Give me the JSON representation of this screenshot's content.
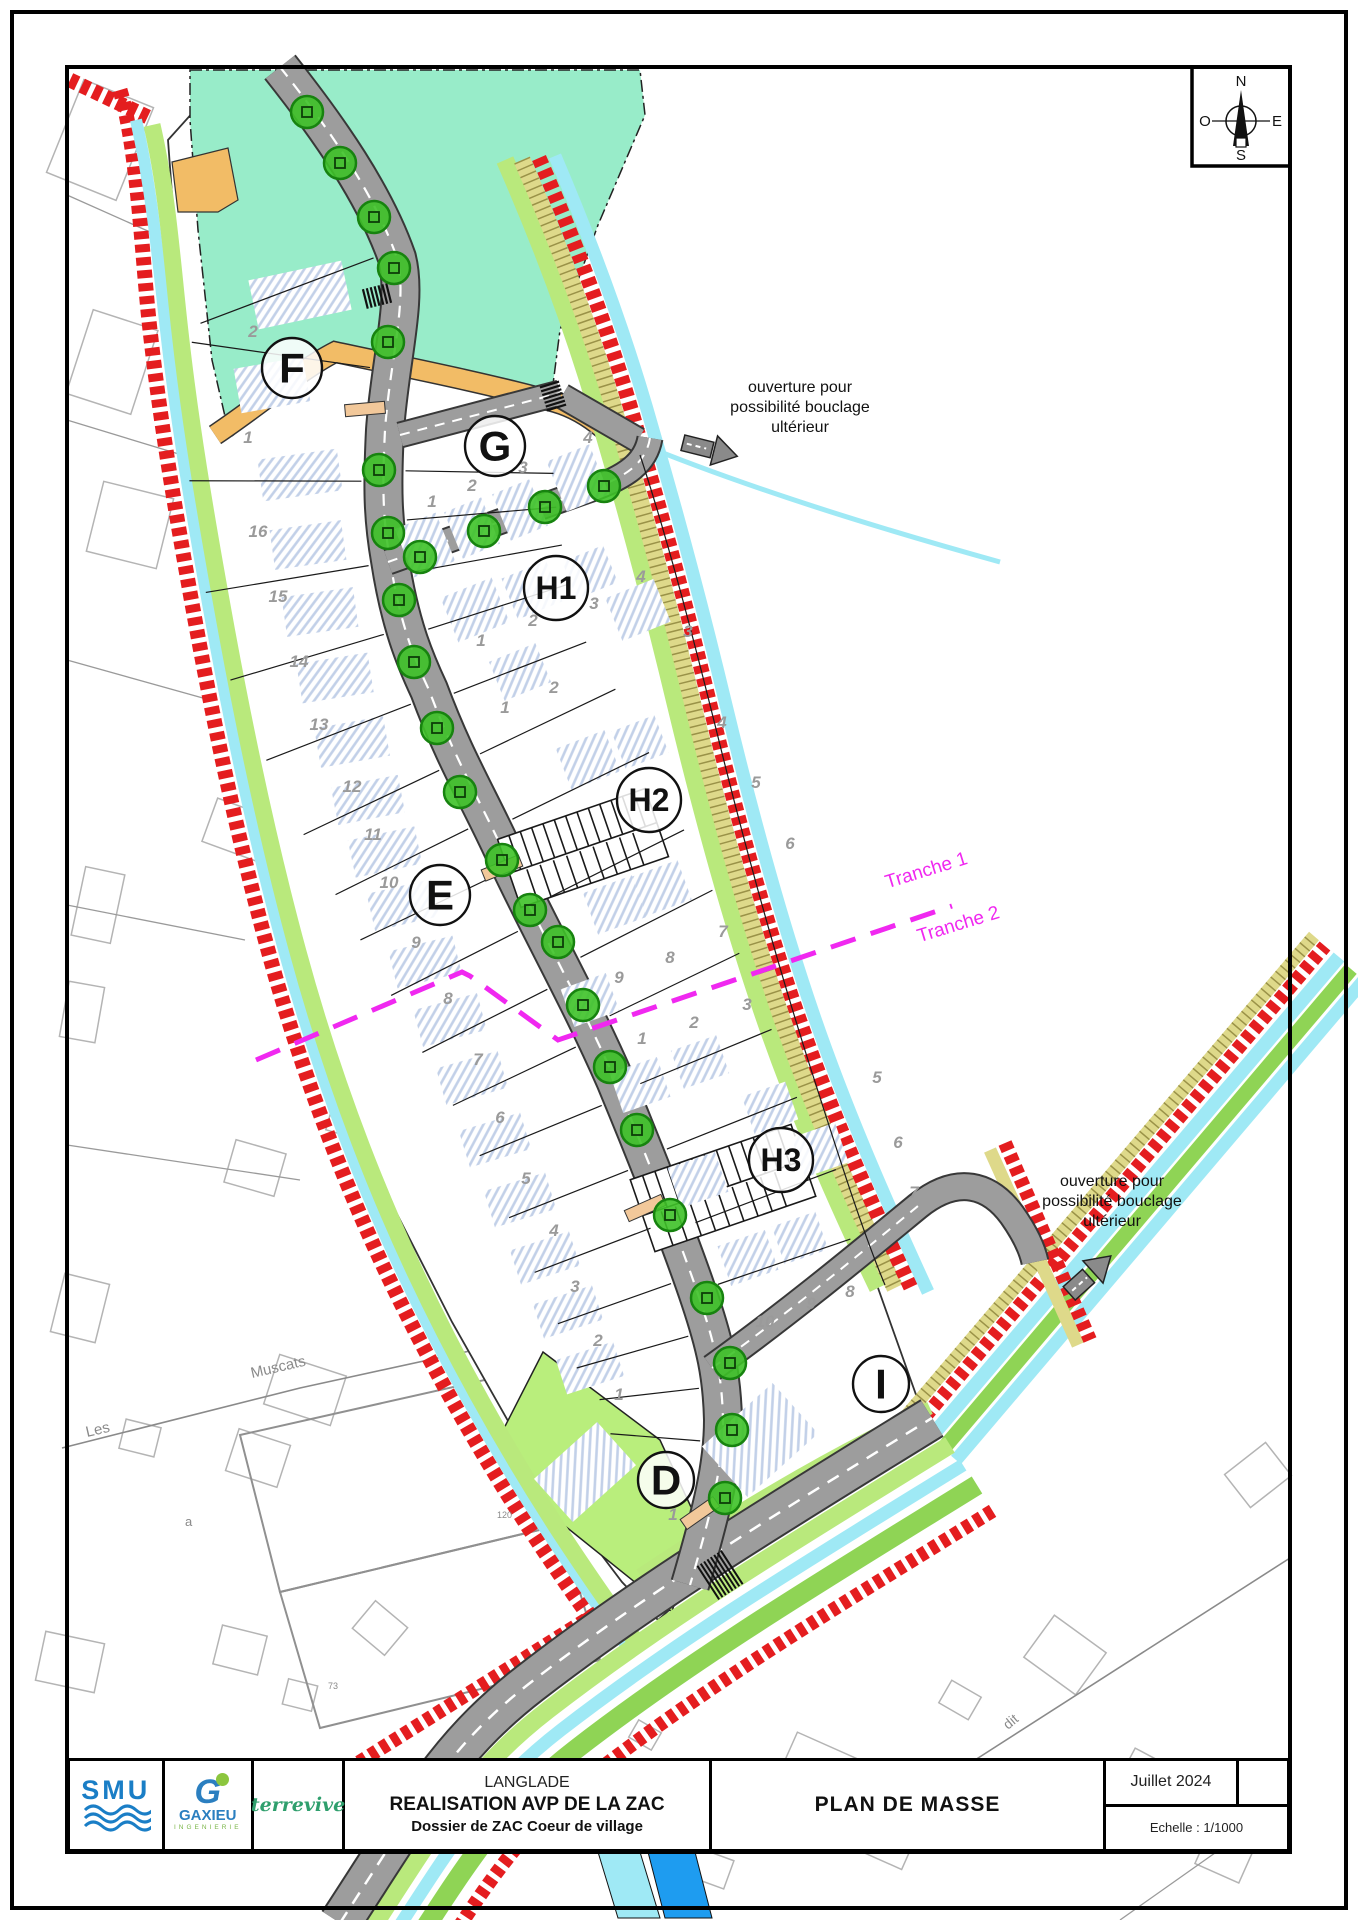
{
  "title_block": {
    "smu": "SMU",
    "gaxieu": "GAXIEU",
    "gaxieu_g": "G",
    "gaxieu_sub": "INGENIERIE",
    "terravia": "terrevive",
    "commune": "LANGLADE",
    "project": "REALISATION AVP DE LA ZAC",
    "dossier": "Dossier de ZAC Coeur de village",
    "doc_title": "PLAN DE MASSE",
    "date": "Juillet 2024",
    "scale": "Echelle : 1/1000"
  },
  "compass": {
    "n": "N",
    "s": "S",
    "e": "E",
    "o": "O"
  },
  "annotations": [
    {
      "lines": [
        "ouverture pour",
        "possibilité bouclage",
        "ultérieur"
      ],
      "x": 800,
      "y": 392
    },
    {
      "lines": [
        "ouverture pour",
        "possibilité bouclage",
        "ultérieur"
      ],
      "x": 1112,
      "y": 1186
    }
  ],
  "tranche_labels": [
    {
      "text": "Tranche 1",
      "x": 928,
      "y": 876,
      "rot": -17
    },
    {
      "text": "Tranche 2",
      "x": 960,
      "y": 930,
      "rot": -17
    }
  ],
  "zones": [
    {
      "label": "F",
      "x": 292,
      "y": 368,
      "r": 30,
      "fs": 42
    },
    {
      "label": "G",
      "x": 495,
      "y": 446,
      "r": 30,
      "fs": 42
    },
    {
      "label": "H1",
      "x": 556,
      "y": 588,
      "r": 32,
      "fs": 32
    },
    {
      "label": "H2",
      "x": 649,
      "y": 800,
      "r": 32,
      "fs": 32
    },
    {
      "label": "E",
      "x": 440,
      "y": 895,
      "r": 30,
      "fs": 42
    },
    {
      "label": "H3",
      "x": 781,
      "y": 1160,
      "r": 32,
      "fs": 32
    },
    {
      "label": "I",
      "x": 881,
      "y": 1384,
      "r": 28,
      "fs": 42
    },
    {
      "label": "D",
      "x": 666,
      "y": 1480,
      "r": 28,
      "fs": 42
    }
  ],
  "parcels": [
    {
      "n": "2",
      "x": 253,
      "y": 337
    },
    {
      "n": "1",
      "x": 248,
      "y": 443
    },
    {
      "n": "16",
      "x": 258,
      "y": 537
    },
    {
      "n": "15",
      "x": 278,
      "y": 602
    },
    {
      "n": "14",
      "x": 299,
      "y": 667
    },
    {
      "n": "13",
      "x": 319,
      "y": 730
    },
    {
      "n": "12",
      "x": 352,
      "y": 792
    },
    {
      "n": "11",
      "x": 373,
      "y": 840
    },
    {
      "n": "10",
      "x": 389,
      "y": 888
    },
    {
      "n": "9",
      "x": 416,
      "y": 948
    },
    {
      "n": "8",
      "x": 448,
      "y": 1004
    },
    {
      "n": "7",
      "x": 478,
      "y": 1065
    },
    {
      "n": "6",
      "x": 500,
      "y": 1123
    },
    {
      "n": "5",
      "x": 526,
      "y": 1184
    },
    {
      "n": "4",
      "x": 554,
      "y": 1236
    },
    {
      "n": "3",
      "x": 575,
      "y": 1292
    },
    {
      "n": "2",
      "x": 598,
      "y": 1346
    },
    {
      "n": "1",
      "x": 619,
      "y": 1400
    },
    {
      "n": "1",
      "x": 673,
      "y": 1520
    },
    {
      "n": "1",
      "x": 432,
      "y": 507
    },
    {
      "n": "2",
      "x": 472,
      "y": 491
    },
    {
      "n": "3",
      "x": 523,
      "y": 473
    },
    {
      "n": "4",
      "x": 588,
      "y": 443
    },
    {
      "n": "1",
      "x": 481,
      "y": 646
    },
    {
      "n": "2",
      "x": 533,
      "y": 626
    },
    {
      "n": "3",
      "x": 594,
      "y": 609
    },
    {
      "n": "4",
      "x": 641,
      "y": 582
    },
    {
      "n": "1",
      "x": 505,
      "y": 713
    },
    {
      "n": "2",
      "x": 554,
      "y": 693
    },
    {
      "n": "3",
      "x": 688,
      "y": 637
    },
    {
      "n": "4",
      "x": 722,
      "y": 728
    },
    {
      "n": "5",
      "x": 756,
      "y": 788
    },
    {
      "n": "6",
      "x": 790,
      "y": 849
    },
    {
      "n": "7",
      "x": 723,
      "y": 937
    },
    {
      "n": "8",
      "x": 670,
      "y": 963
    },
    {
      "n": "9",
      "x": 619,
      "y": 983
    },
    {
      "n": "1",
      "x": 642,
      "y": 1044
    },
    {
      "n": "2",
      "x": 694,
      "y": 1028
    },
    {
      "n": "3",
      "x": 747,
      "y": 1010
    },
    {
      "n": "5",
      "x": 877,
      "y": 1083
    },
    {
      "n": "6",
      "x": 898,
      "y": 1148
    },
    {
      "n": "7",
      "x": 914,
      "y": 1198
    },
    {
      "n": "8",
      "x": 850,
      "y": 1297
    },
    {
      "n": "9",
      "x": 811,
      "y": 1309
    },
    {
      "n": "10",
      "x": 765,
      "y": 1327
    }
  ],
  "context_labels": [
    {
      "text": "Les",
      "x": 87,
      "y": 1437,
      "rot": -13,
      "size": 15
    },
    {
      "text": "Muscats",
      "x": 252,
      "y": 1378,
      "rot": -13,
      "size": 15
    },
    {
      "text": "a",
      "x": 185,
      "y": 1526,
      "rot": 0,
      "size": 13
    },
    {
      "text": "120",
      "x": 497,
      "y": 1518,
      "rot": 0,
      "size": 9
    },
    {
      "text": "73",
      "x": 328,
      "y": 1689,
      "rot": 0,
      "size": 9
    },
    {
      "text": "dit",
      "x": 1008,
      "y": 1730,
      "rot": -40,
      "size": 14
    }
  ],
  "trees": [
    [
      307,
      112
    ],
    [
      340,
      163
    ],
    [
      374,
      217
    ],
    [
      394,
      268
    ],
    [
      388,
      342
    ],
    [
      379,
      470
    ],
    [
      388,
      533
    ],
    [
      399,
      600
    ],
    [
      414,
      662
    ],
    [
      420,
      557
    ],
    [
      484,
      531
    ],
    [
      545,
      507
    ],
    [
      604,
      486
    ],
    [
      437,
      728
    ],
    [
      460,
      792
    ],
    [
      502,
      860
    ],
    [
      530,
      910
    ],
    [
      558,
      942
    ],
    [
      583,
      1005
    ],
    [
      610,
      1067
    ],
    [
      637,
      1130
    ],
    [
      670,
      1215
    ],
    [
      707,
      1298
    ],
    [
      730,
      1363
    ],
    [
      732,
      1430
    ],
    [
      725,
      1498
    ]
  ],
  "colors": {
    "red_hatch": "#e41d1f",
    "stream_cyan": "#9fe9f5",
    "verge_green": "#b9e97c",
    "park_mint": "#98ecc9",
    "path_orange": "#f2bc66",
    "road_gray": "#9d9d9d",
    "tree_green": "#3ec228",
    "tranche_magenta": "#f028f0",
    "building_hatch_blue": "#c2d0e8",
    "khaki_band": "#ded98a",
    "logo_blue": "#1a7ec6",
    "logo_green": "#7ab648",
    "terravia_green": "#2f9f6d"
  }
}
